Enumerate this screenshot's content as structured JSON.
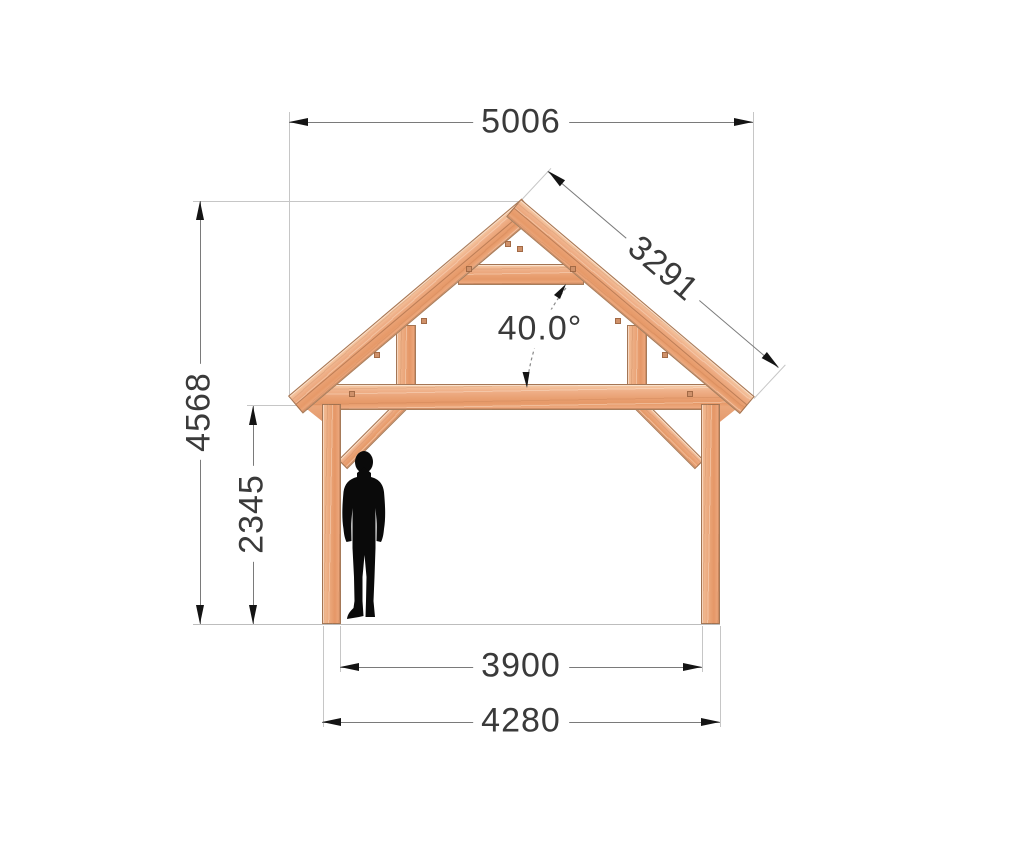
{
  "title": "Timber frame gazebo / carport front elevation with dimensions",
  "dimensions": {
    "total_width": {
      "value": "5006",
      "orientation": "horizontal",
      "location": "top, overall roof width"
    },
    "rafter_length": {
      "value": "3291",
      "orientation": "along roof slope",
      "location": "right roof slope"
    },
    "roof_angle": {
      "value": "40.0°",
      "location": "between rafter and tie beam"
    },
    "total_height": {
      "value": "4568",
      "orientation": "vertical",
      "location": "ground to ridge"
    },
    "eave_height": {
      "value": "2345",
      "orientation": "vertical",
      "location": "ground to underside of eave beam"
    },
    "inner_span": {
      "value": "3900",
      "orientation": "horizontal",
      "location": "between post inner faces"
    },
    "outer_span": {
      "value": "4280",
      "orientation": "horizontal",
      "location": "between post outer faces"
    }
  },
  "structure": {
    "material": "timber",
    "members": [
      "left post",
      "right post",
      "tie beam",
      "collar beam",
      "left rafter",
      "right rafter",
      "left knee brace",
      "right knee brace",
      "left queen stud",
      "right queen stud",
      "left eave wedge",
      "right eave wedge"
    ]
  },
  "scale_figure": {
    "type": "human silhouette",
    "style": "black, standing man in suit"
  },
  "colors": {
    "wood_light": "#f6cba6",
    "wood_mid": "#eba77b",
    "wood_dark": "#e09468",
    "wood_edge": "#b3855f",
    "peg": "#cf916a",
    "dim_line": "#7a7a7a",
    "ext_line": "#c6c6c6",
    "arrow": "#141414",
    "text": "#3a3a3a",
    "figure": "#0a0a0a",
    "background": "#ffffff"
  }
}
